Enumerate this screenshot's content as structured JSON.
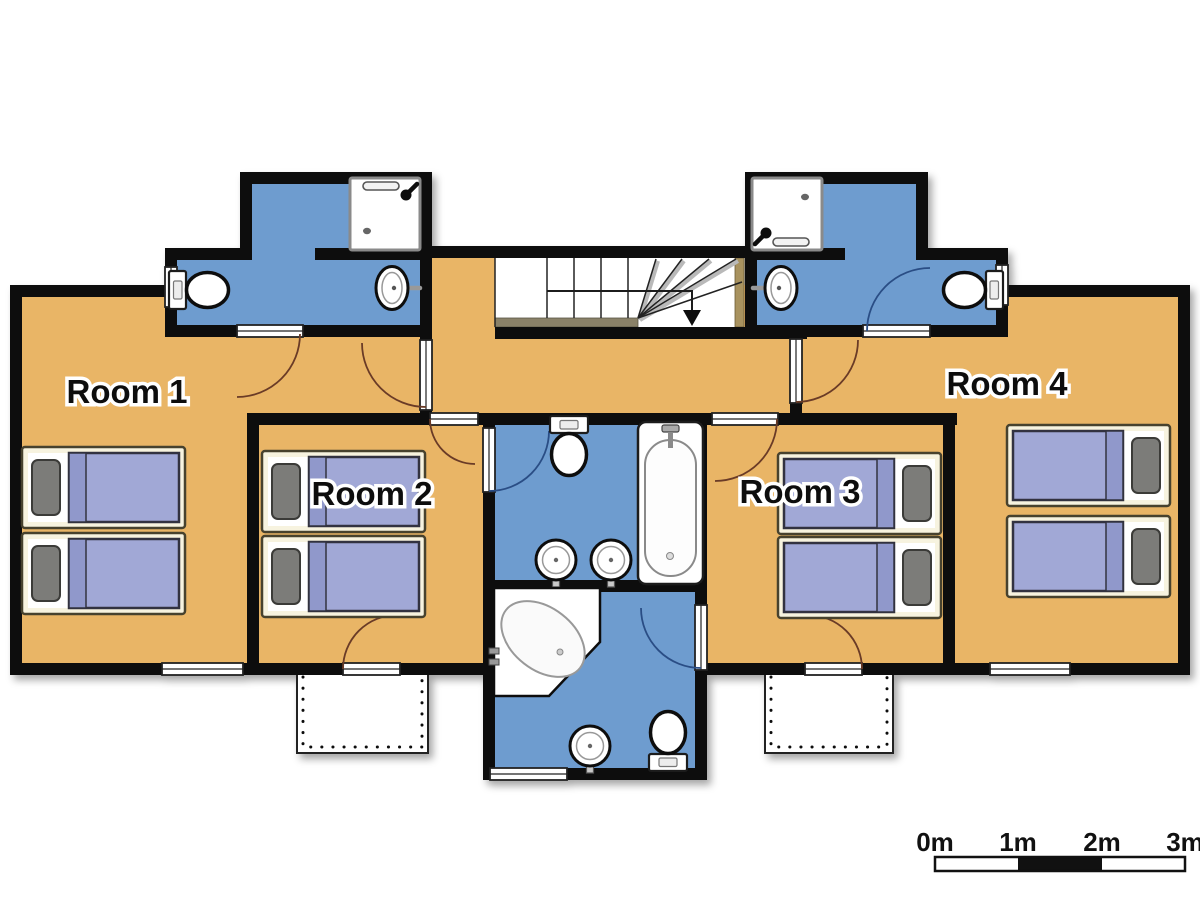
{
  "plan": {
    "rooms": [
      {
        "id": "room-1",
        "label": "Room 1",
        "beds": 2
      },
      {
        "id": "room-2",
        "label": "Room 2",
        "beds": 2
      },
      {
        "id": "room-3",
        "label": "Room 3",
        "beds": 2
      },
      {
        "id": "room-4",
        "label": "Room 4",
        "beds": 2
      }
    ],
    "bathrooms": [
      {
        "id": "bathroom-top-left",
        "fixtures": [
          "shower",
          "toilet",
          "sink"
        ]
      },
      {
        "id": "bathroom-top-right",
        "fixtures": [
          "shower",
          "sink",
          "toilet"
        ]
      },
      {
        "id": "bathroom-center-top",
        "fixtures": [
          "toilet",
          "bathtub",
          "sink",
          "sink"
        ]
      },
      {
        "id": "bathroom-center-bottom",
        "fixtures": [
          "corner-bathtub",
          "sink",
          "toilet"
        ]
      }
    ],
    "stairs": {
      "arrow": "down"
    },
    "balconies": 2,
    "colors": {
      "floor": "#E9B566",
      "bathroom_floor": "#6E9CCF",
      "wall": "#0D0D0D",
      "bed_frame": "#F7F3DF",
      "bed_blanket": "#A1A8D6",
      "pillow": "#7B7B79",
      "door_swing_room": "#6A3B28",
      "door_swing_bath": "#2A4E85"
    }
  },
  "scale_bar": {
    "labels": [
      "0m",
      "1m",
      "2m",
      "3m"
    ]
  }
}
